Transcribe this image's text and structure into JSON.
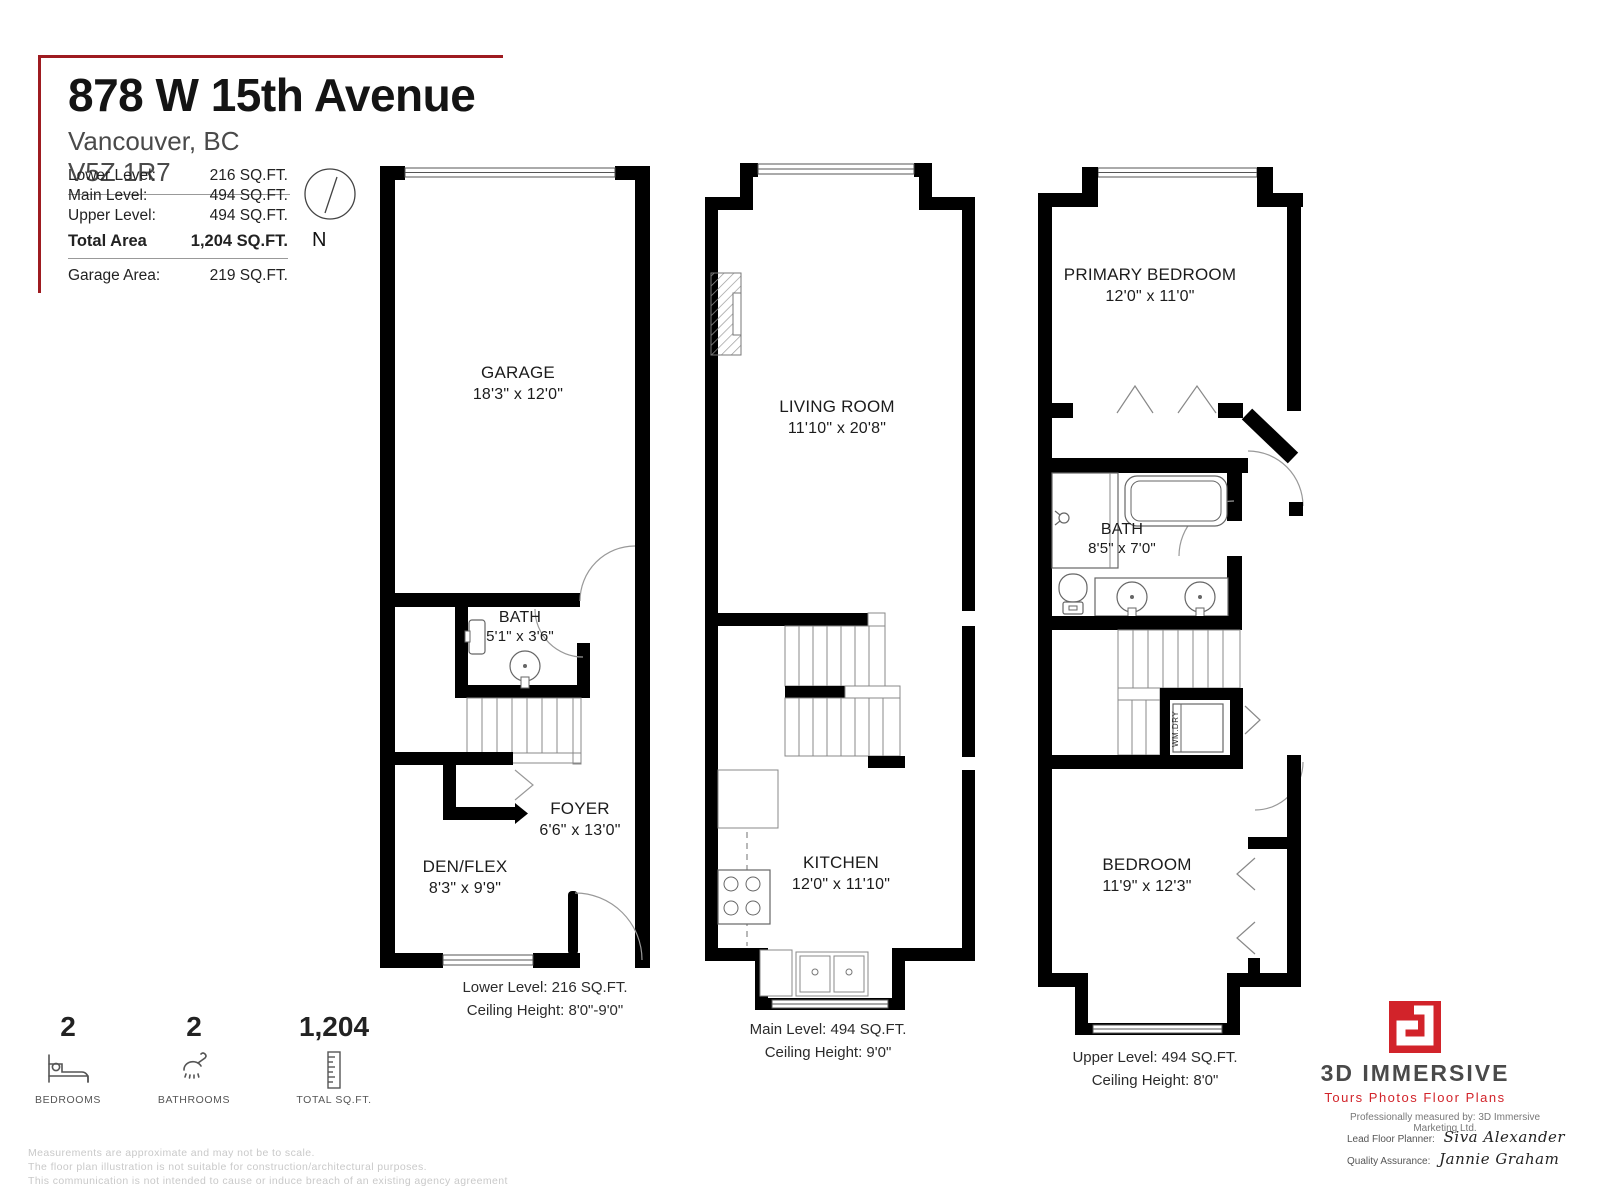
{
  "header": {
    "title": "878 W 15th Avenue",
    "subtitle": "Vancouver, BC V5Z 1R7",
    "areas": [
      {
        "label": "Lower Level:",
        "value": "216 SQ.FT."
      },
      {
        "label": "Main Level:",
        "value": "494 SQ.FT."
      },
      {
        "label": "Upper Level:",
        "value": "494 SQ.FT."
      }
    ],
    "total": {
      "label": "Total Area",
      "value": "1,204 SQ.FT."
    },
    "garage": {
      "label": "Garage Area:",
      "value": "219 SQ.FT."
    },
    "compass_label": "N",
    "compass_icon": "compass-icon"
  },
  "plans": {
    "lower": {
      "rooms": [
        {
          "name": "GARAGE",
          "dims": "18'3\" x 12'0\""
        },
        {
          "name": "BATH",
          "dims": "5'1\" x 3'6\""
        },
        {
          "name": "FOYER",
          "dims": "6'6\" x 13'0\""
        },
        {
          "name": "DEN/FLEX",
          "dims": "8'3\" x 9'9\""
        }
      ],
      "caption_line1": "Lower Level: 216 SQ.FT.",
      "caption_line2": "Ceiling Height: 8'0\"-9'0\""
    },
    "main": {
      "rooms": [
        {
          "name": "LIVING ROOM",
          "dims": "11'10\" x 20'8\""
        },
        {
          "name": "KITCHEN",
          "dims": "12'0\" x 11'10\""
        }
      ],
      "caption_line1": "Main Level: 494 SQ.FT.",
      "caption_line2": "Ceiling Height: 9'0\""
    },
    "upper": {
      "rooms": [
        {
          "name": "PRIMARY BEDROOM",
          "dims": "12'0\" x 11'0\""
        },
        {
          "name": "BATH",
          "dims": "8'5\" x 7'0\""
        },
        {
          "name": "BEDROOM",
          "dims": "11'9\" x 12'3\""
        }
      ],
      "appliance_label": "WM.DRY",
      "caption_line1": "Upper Level: 494 SQ.FT.",
      "caption_line2": "Ceiling Height: 8'0\""
    }
  },
  "stats": [
    {
      "value": "2",
      "label": "BEDROOMS",
      "icon": "bed-icon"
    },
    {
      "value": "2",
      "label": "BATHROOMS",
      "icon": "shower-icon"
    },
    {
      "value": "1,204",
      "label": "TOTAL SQ.FT.",
      "icon": "ruler-icon"
    }
  ],
  "branding": {
    "logo_icon": "logo-mark",
    "name": "3D IMMERSIVE",
    "tagline": "Tours  Photos  Floor Plans",
    "measured_by": "Professionally measured by: 3D Immersive Marketing Ltd.",
    "planner_label": "Lead Floor Planner:",
    "planner_name": "Siva Alexander",
    "qa_label": "Quality Assurance:",
    "qa_name": "Jannie Graham"
  },
  "disclaimer": [
    "Measurements are approximate and may not be to scale.",
    "The floor plan illustration is not suitable for construction/architectural purposes.",
    "This communication is not intended to cause or induce breach of an existing agency agreement"
  ],
  "colors": {
    "wall": "#000000",
    "accent_dark_red": "#9e1b20",
    "brand_red": "#d2232a",
    "brand_gray": "#4a4a4a",
    "disclaimer_gray": "#c9c9c9"
  }
}
